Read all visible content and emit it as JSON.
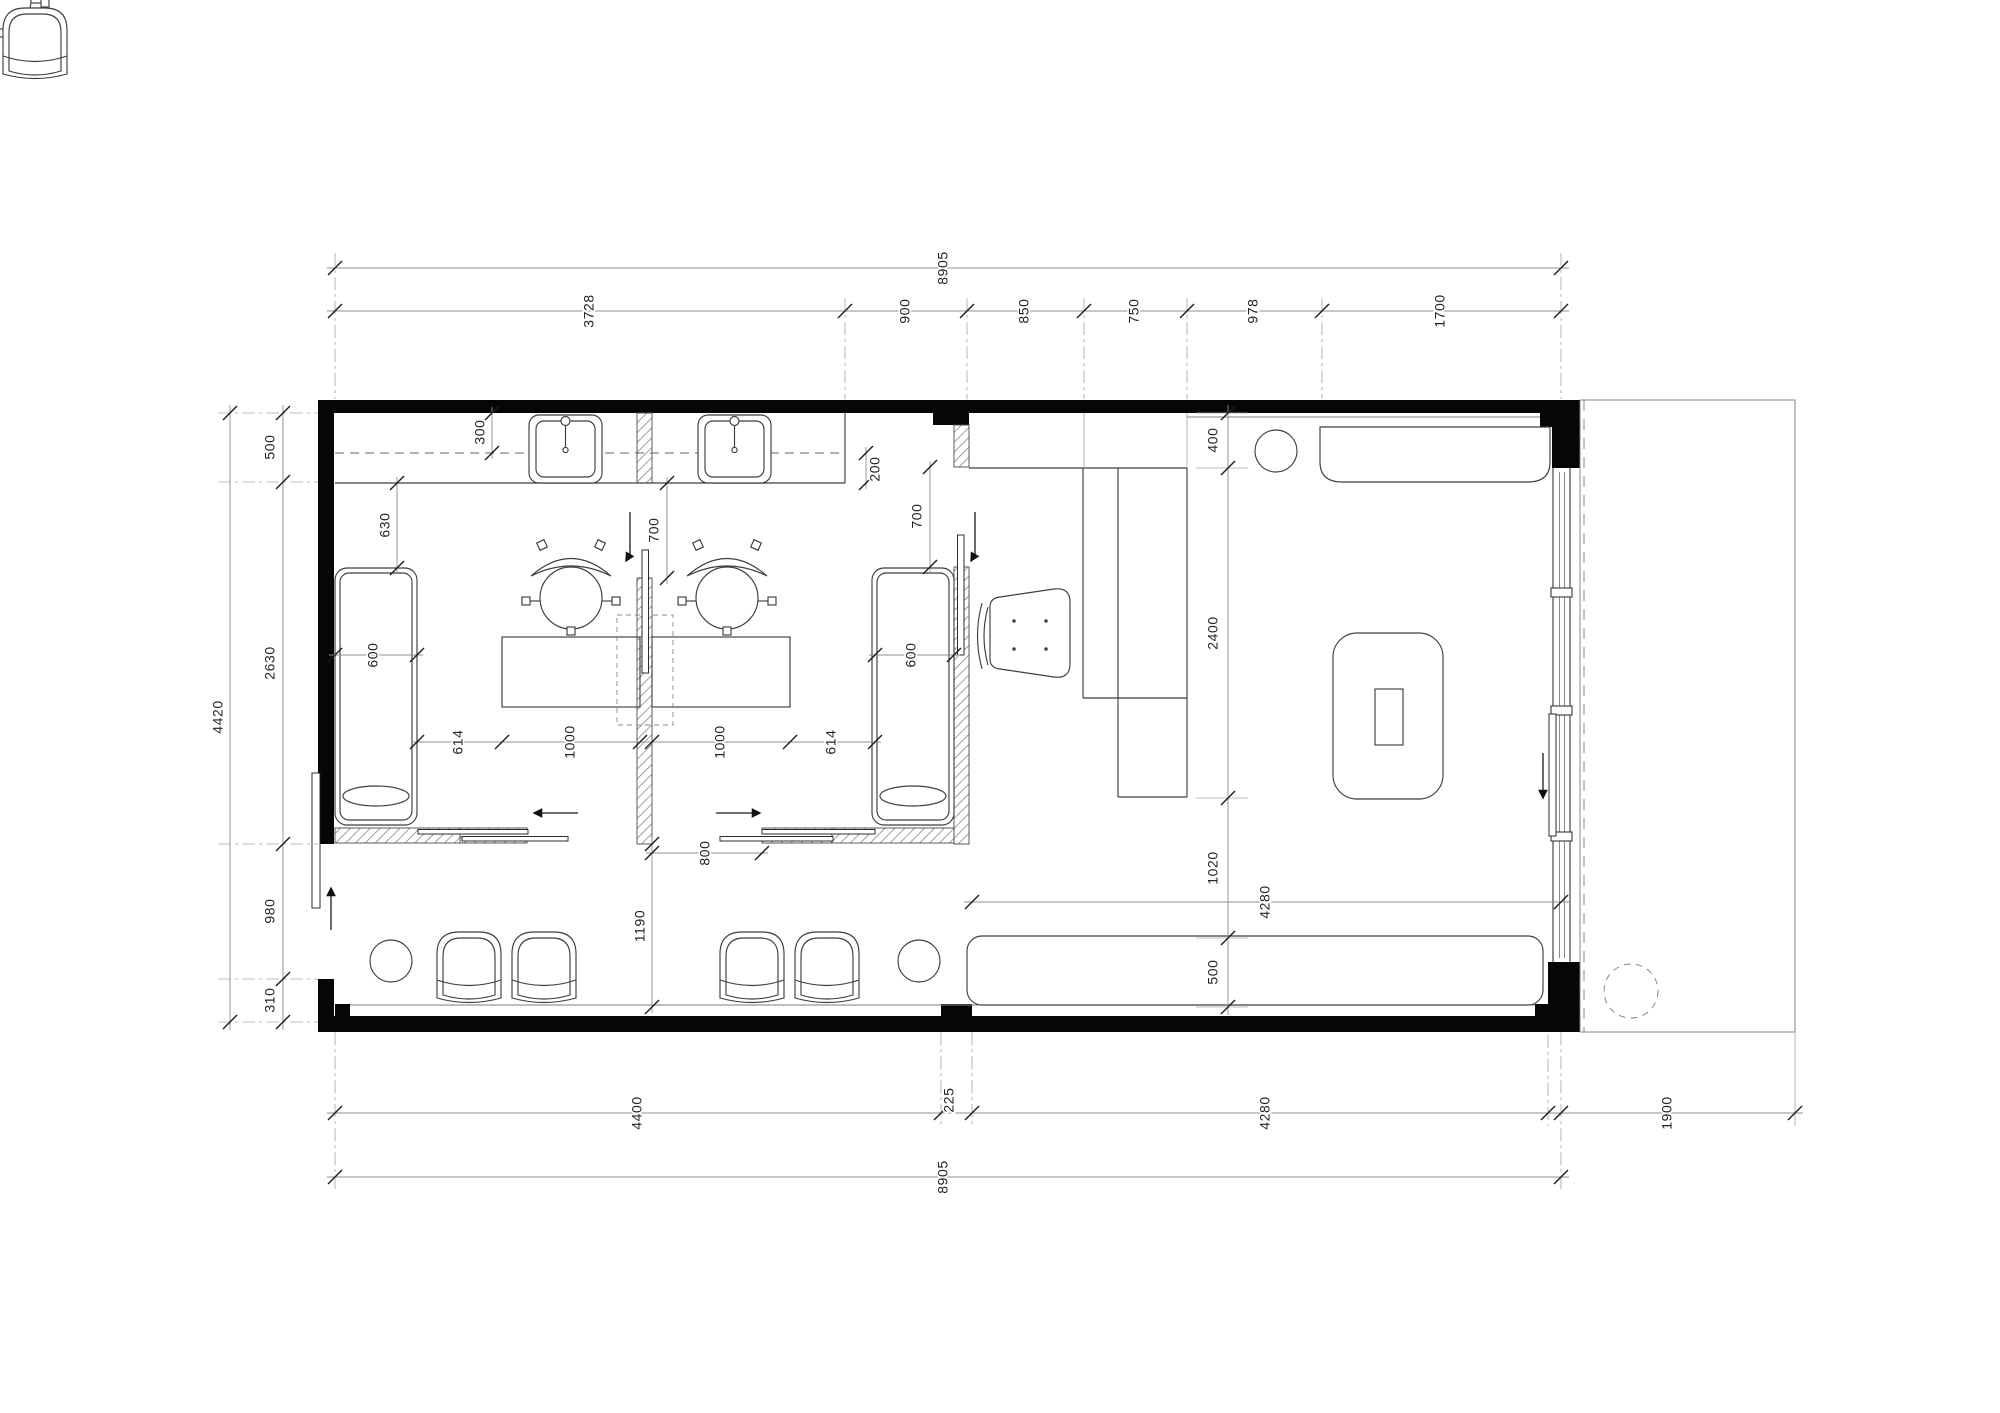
{
  "page": {
    "background": "#ffffff"
  },
  "drawing": {
    "type": "architectural-floor-plan",
    "units": "mm",
    "wall_color": "#060606",
    "dim_text_color": "#232323",
    "dims": {
      "top_overall": "8905",
      "top_chain": [
        "3728",
        "900",
        "850",
        "750",
        "978",
        "1700"
      ],
      "left_overall": "4420",
      "left_chain": [
        "500",
        "2630",
        "980",
        "310"
      ],
      "right_chain": [
        "400",
        "2400",
        "1020",
        "500"
      ],
      "bottom_chain": [
        "4400",
        "225",
        "4280"
      ],
      "bottom_overall": "8905",
      "terrace_width": "1900",
      "lounge_width": "4280",
      "interior": {
        "counter_depth_back": "300",
        "counter_depth_front": "200",
        "bed_clearance": "630",
        "bed1_width": "600",
        "bed2_width": "600",
        "room1_door_opening": "700",
        "room2_door_opening": "700",
        "room1_chain": [
          "614",
          "1000"
        ],
        "room2_chain": [
          "1000",
          "614"
        ],
        "sliding_door_opening": "800",
        "corridor_width": "1190"
      }
    }
  }
}
